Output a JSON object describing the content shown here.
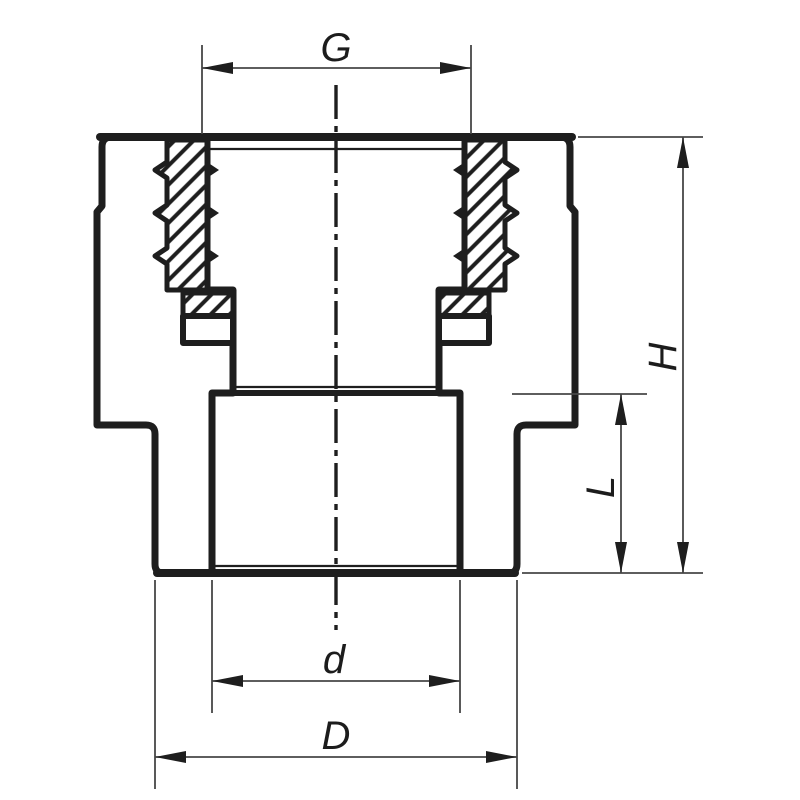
{
  "drawing": {
    "description": "cross-section of threaded reducing pipe fitting",
    "background_color": "#ffffff",
    "line_color": "#1e1e1e",
    "dimension_line_color": "#474747",
    "labels": {
      "thread_size": "G",
      "overall_height": "H",
      "socket_depth": "L",
      "inner_diameter": "d",
      "outer_diameter": "D"
    }
  }
}
